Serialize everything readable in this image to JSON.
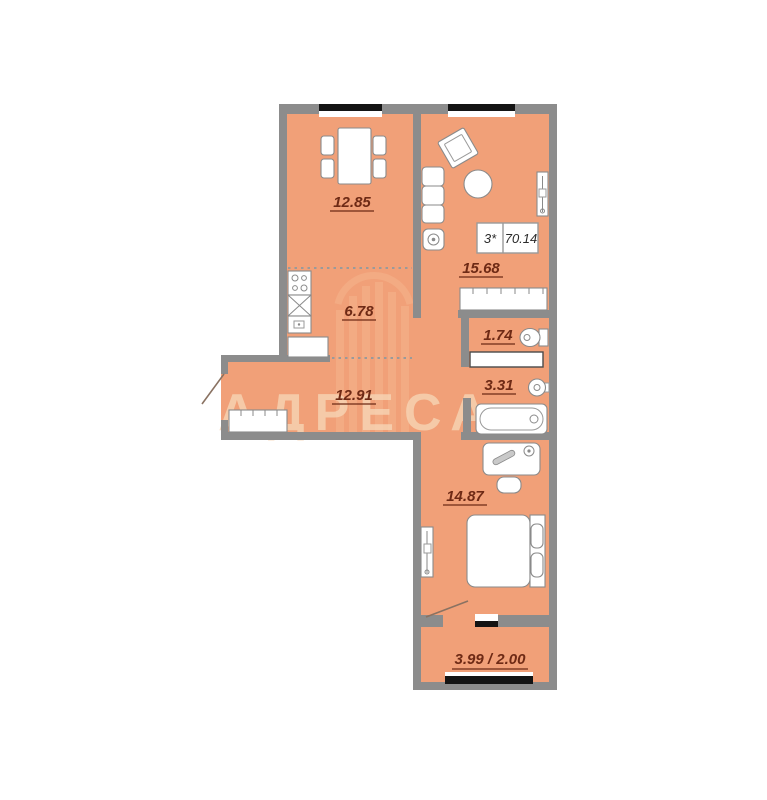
{
  "plan": {
    "apartment_label": {
      "rooms_type": "3*",
      "total_area": "70.14"
    },
    "rooms": {
      "dining": {
        "area": "12.85"
      },
      "living": {
        "area": "15.68"
      },
      "kitchen": {
        "area": "6.78"
      },
      "wc": {
        "area": "1.74"
      },
      "bathroom": {
        "area": "3.31"
      },
      "hallway": {
        "area": "12.91"
      },
      "bedroom": {
        "area": "14.87"
      },
      "balcony": {
        "area": "3.99 / 2.00"
      }
    },
    "watermark": {
      "text": "АДРЕСА"
    },
    "colors": {
      "floor": "#F1A078",
      "wall": "#8C8C8C",
      "window": "#141414",
      "label_text": "#6E2A15",
      "watermark": "#F7D5B5"
    }
  }
}
